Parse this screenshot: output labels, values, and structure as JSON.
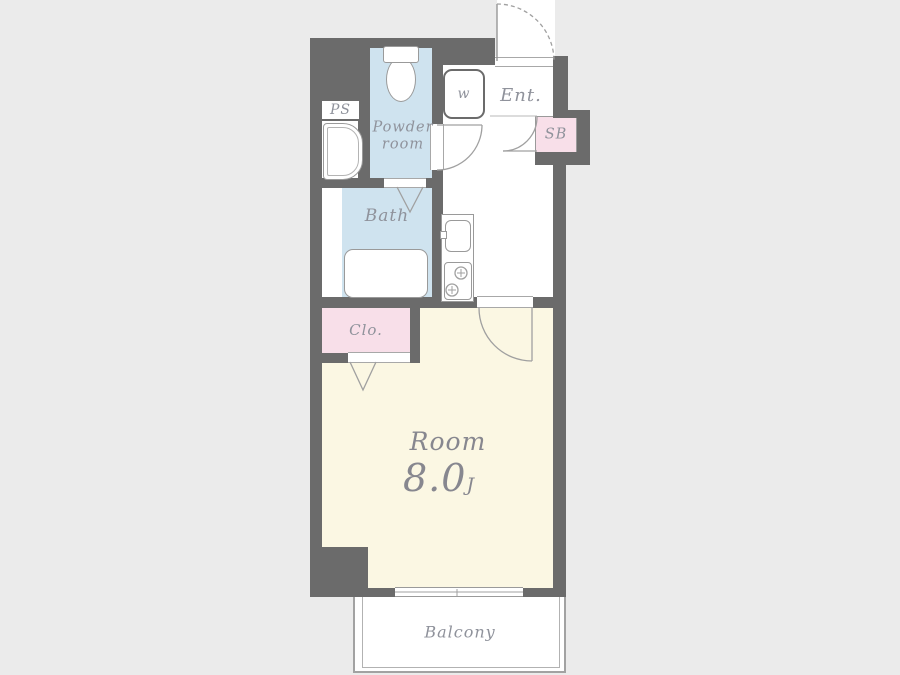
{
  "colors": {
    "background": "#ebebeb",
    "wall": "#6b6b6b",
    "water_room_fill": "#cfe3ef",
    "closet_fill": "#f8dfe9",
    "room_fill": "#fbf7e3",
    "line": "#a0a0a0",
    "label_text": "#8f929b"
  },
  "rooms": {
    "pipe_space": {
      "label": "PS"
    },
    "powder_room": {
      "label_line1": "Powder",
      "label_line2": "room"
    },
    "w_closet": {
      "label": "w"
    },
    "entrance": {
      "label": "Ent."
    },
    "shoe_box": {
      "label": "SB"
    },
    "bath": {
      "label": "Bath"
    },
    "closet": {
      "label": "Clo."
    },
    "main_room": {
      "label": "Room",
      "area": "8.0",
      "area_unit": "J"
    },
    "balcony": {
      "label": "Balcony"
    }
  }
}
